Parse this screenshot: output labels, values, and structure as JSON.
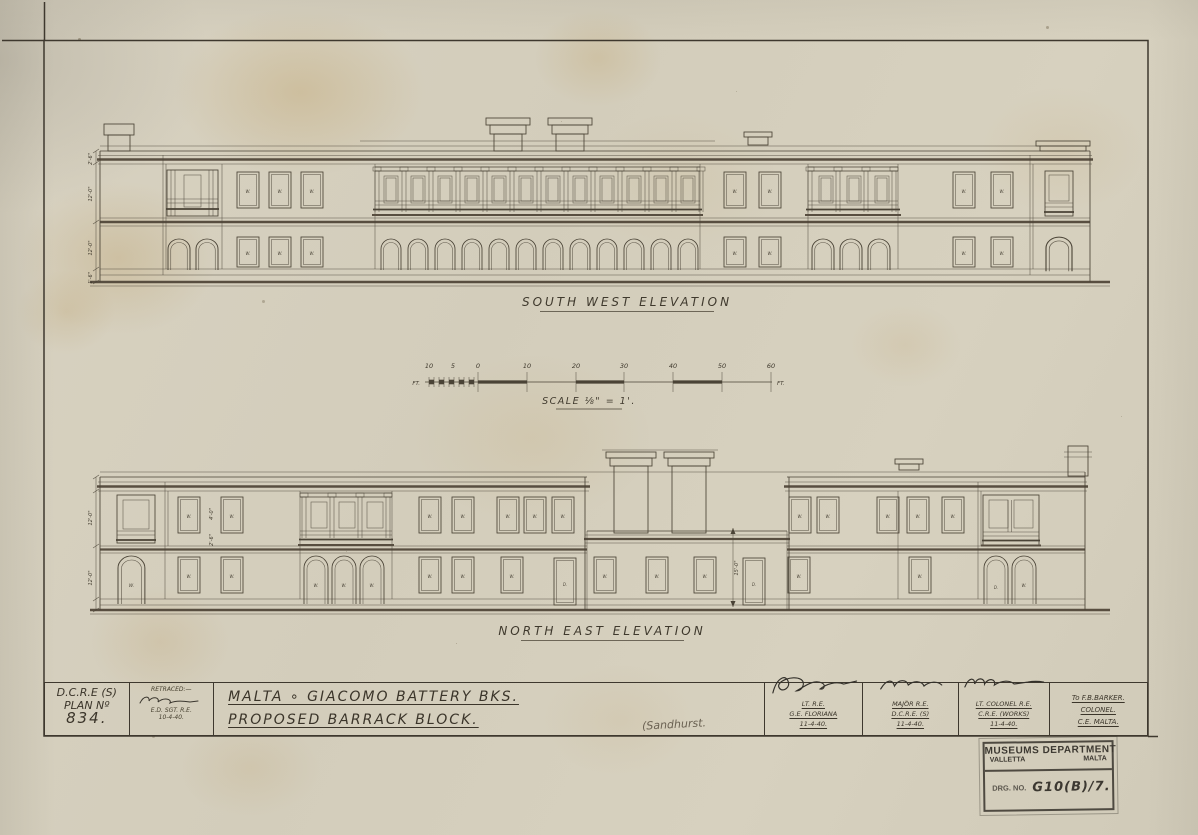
{
  "title_block": {
    "plan": {
      "org": "D.C.R.E (S)",
      "label": "PLAN Nº",
      "number": "834."
    },
    "retraced": {
      "heading": "RETRACED:—",
      "rank": "E.D. SGT. R.E.",
      "date": "10-4-40."
    },
    "title": {
      "line1": "MALTA ∘ GIACOMO BATTERY BKS.",
      "line2": "PROPOSED BARRACK BLOCK.",
      "note": "(Sandhurst."
    },
    "signatures": [
      {
        "rank": "LT. R.E.",
        "unit": "G.E. FLORIANA",
        "date": "11-4-40."
      },
      {
        "rank": "MAJOR R.E.",
        "unit": "D.C.R.E. (S)",
        "date": "11-4-40."
      },
      {
        "rank": "LT. COLONEL R.E.",
        "unit": "C.R.E. (WORKS)",
        "date": "11-4-40."
      },
      {
        "rank": "To F.B.BARKER.",
        "unit": "COLONEL.",
        "date": "C.E. MALTA."
      }
    ]
  },
  "stamp": {
    "department": "MUSEUMS DEPARTMENT",
    "city": "VALLETTA",
    "country": "MALTA",
    "drg_label": "DRG. NO.",
    "drg_number": "G10(B)/7."
  },
  "drawings": {
    "sw_title": "SOUTH WEST ELEVATION",
    "ne_title": "NORTH EAST ELEVATION",
    "scale": {
      "caption": "SCALE ⅛\" = 1'.",
      "unit_left": "FT.",
      "unit_right": "FT.",
      "labels": [
        "10",
        "5",
        "0",
        "10",
        "20",
        "30",
        "40",
        "50",
        "60"
      ]
    },
    "labels": {
      "window": "W.",
      "door": "D."
    },
    "dims": {
      "sw": [
        "2'-6\"",
        "12'-0\"",
        "12'-0\"",
        "1'-6\""
      ],
      "ne": [
        "12'-0\"",
        "12'-0\""
      ],
      "win_w": "4'-0\"",
      "win_h": "2'-6\"",
      "centre": "15'-0\""
    }
  }
}
